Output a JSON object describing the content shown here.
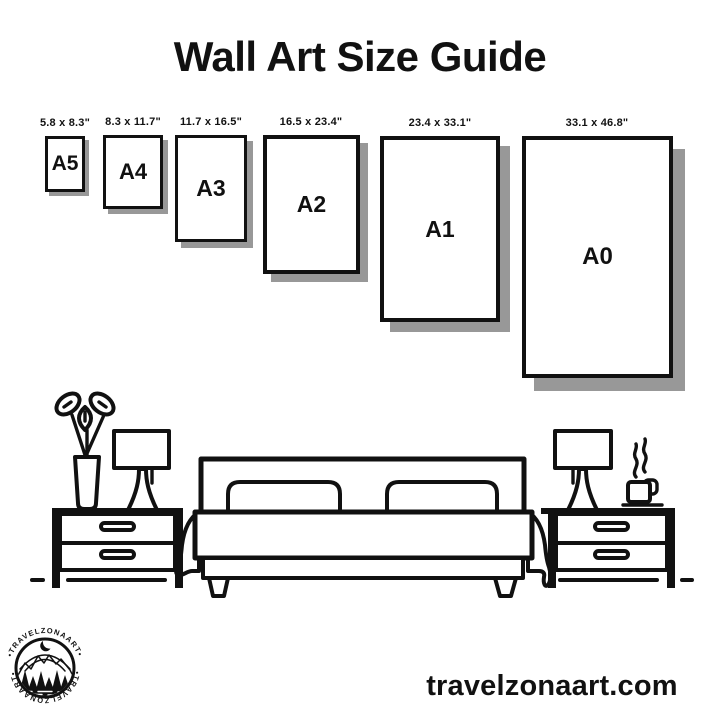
{
  "title": "Wall Art Size Guide",
  "papers": [
    {
      "name": "A5",
      "dims": "5.8 x 8.3\""
    },
    {
      "name": "A4",
      "dims": "8.3 x 11.7\""
    },
    {
      "name": "A3",
      "dims": "11.7 x 16.5\""
    },
    {
      "name": "A2",
      "dims": "16.5 x 23.4\""
    },
    {
      "name": "A1",
      "dims": "23.4 x 33.1\""
    },
    {
      "name": "A0",
      "dims": "33.1 x 46.8\""
    }
  ],
  "illustration": {
    "scene": "bedroom line art",
    "items": [
      "plant-vase",
      "table-lamp",
      "nightstand-left",
      "double-bed-with-pillows",
      "nightstand-right",
      "coffee-cup-with-steam"
    ]
  },
  "logo": {
    "ring_text_top": "•TRAVELZONAART•",
    "ring_text_bottom": "•TRAVELZONAART•",
    "emblem": [
      "crescent-moon",
      "mountains",
      "pine-trees",
      "lake"
    ]
  },
  "footer": {
    "website": "travelzonaart.com"
  },
  "colors": {
    "ink": "#111111",
    "paper_shadow": "#989898",
    "background": "#ffffff"
  }
}
